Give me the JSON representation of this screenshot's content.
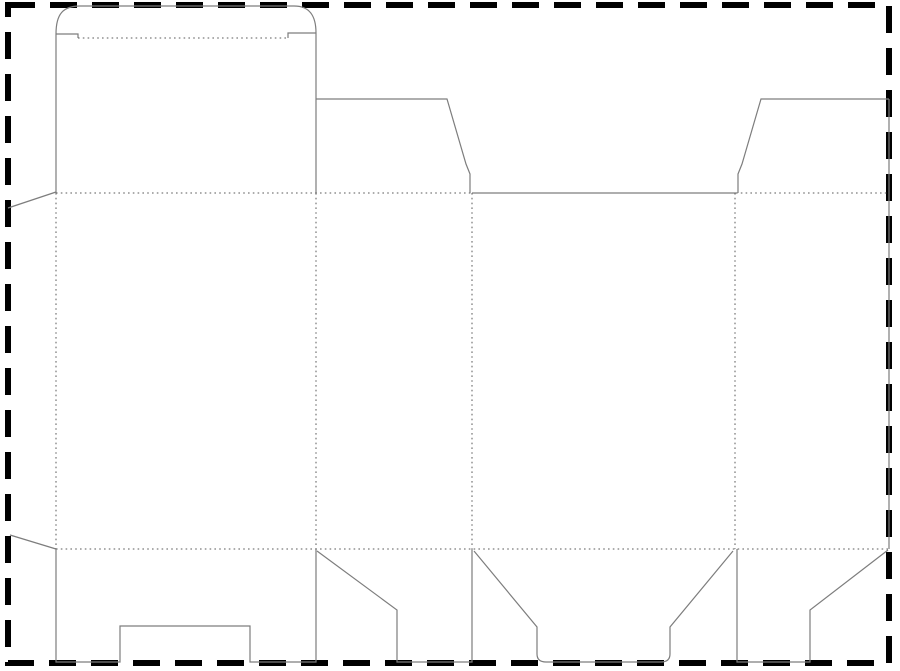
{
  "diagram": {
    "type": "packaging-dieline",
    "description": "Die-cut template (dieline) of a tuck-top folding carton box, shown inside a dashed sheet border",
    "canvas": {
      "width": 900,
      "height": 671,
      "background": "#ffffff"
    },
    "styles": {
      "border": {
        "color": "#000000",
        "stroke_width": 6,
        "dash": "27 15"
      },
      "cut": {
        "color": "#7d7d7d",
        "stroke_width": 1.2,
        "dash": ""
      },
      "fold": {
        "color": "#5a5a5a",
        "stroke_width": 1,
        "dash": "1.6 3.2"
      }
    },
    "sheet_border_rect": {
      "x": 8,
      "y": 5,
      "width": 881,
      "height": 658
    },
    "segments": [
      {
        "name": "tuck-flap-outline-cut",
        "style": "cut",
        "path": "M 56 34 C 56 14 63 6 80 6 L 294 6 C 309 6 316 15 316 33"
      },
      {
        "name": "tuck-flap-left-shoulder-cut",
        "style": "cut",
        "path": "M 56 34 L 78 34 L 78 38"
      },
      {
        "name": "tuck-flap-fold",
        "style": "fold",
        "path": "M 78 38 L 288 38"
      },
      {
        "name": "tuck-flap-right-shoulder-cut",
        "style": "cut",
        "path": "M 288 38 L 288 33 L 316 33"
      },
      {
        "name": "lid-panel-left-cut",
        "style": "cut",
        "path": "M 56 34 L 56 193"
      },
      {
        "name": "lid-panel-right-cut",
        "style": "cut",
        "path": "M 316 33 L 316 193"
      },
      {
        "name": "top-fold-left",
        "style": "fold",
        "path": "M 56 193 L 472 193"
      },
      {
        "name": "top-edge-center-cut",
        "style": "cut",
        "path": "M 472 193 L 736 193"
      },
      {
        "name": "top-fold-right",
        "style": "fold",
        "path": "M 736 193 L 889 193"
      },
      {
        "name": "dust-flap-left-cut",
        "style": "cut",
        "path": "M 316 99 L 447 99 L 466 164 L 470 174 L 470 193"
      },
      {
        "name": "dust-flap-right-cut",
        "style": "cut",
        "path": "M 889 99 L 761 99 L 742 164 L 738 174 L 738 193"
      },
      {
        "name": "sheet-right-edge-cut",
        "style": "cut",
        "path": "M 889 99 L 889 549"
      },
      {
        "name": "glue-flap-top-cut",
        "style": "cut",
        "path": "M 56 192 L 8 208"
      },
      {
        "name": "glue-flap-bottom-cut",
        "style": "cut",
        "path": "M 10 535 L 56 549"
      },
      {
        "name": "panel-fold-1",
        "style": "fold",
        "path": "M 56 193 L 56 549"
      },
      {
        "name": "panel-fold-2",
        "style": "fold",
        "path": "M 316 193 L 316 549"
      },
      {
        "name": "panel-fold-3",
        "style": "fold",
        "path": "M 472 193 L 472 549"
      },
      {
        "name": "panel-fold-4",
        "style": "fold",
        "path": "M 735 193 L 735 549"
      },
      {
        "name": "bottom-fold",
        "style": "fold",
        "path": "M 56 549 L 889 549"
      },
      {
        "name": "bottom-flap-notched-cut",
        "style": "cut",
        "path": "M 56 549 L 56 662 L 120 662 L 120 626 L 250 626 L 250 662 L 316 662 L 316 549"
      },
      {
        "name": "bottom-flap-angled-left-cut",
        "style": "cut",
        "path": "M 317 551 L 397 610 L 397 662 L 472 662 L 472 549"
      },
      {
        "name": "bottom-flap-trapezoid-cut",
        "style": "cut",
        "path": "M 474 551 L 537 627 L 537 654 Q 537 662 546 662 L 661 662 Q 670 662 670 654 L 670 627 L 733 551"
      },
      {
        "name": "bottom-flap-angled-right-cut",
        "style": "cut",
        "path": "M 737 549 L 737 662 L 810 662 L 810 610 L 888 550"
      }
    ]
  }
}
